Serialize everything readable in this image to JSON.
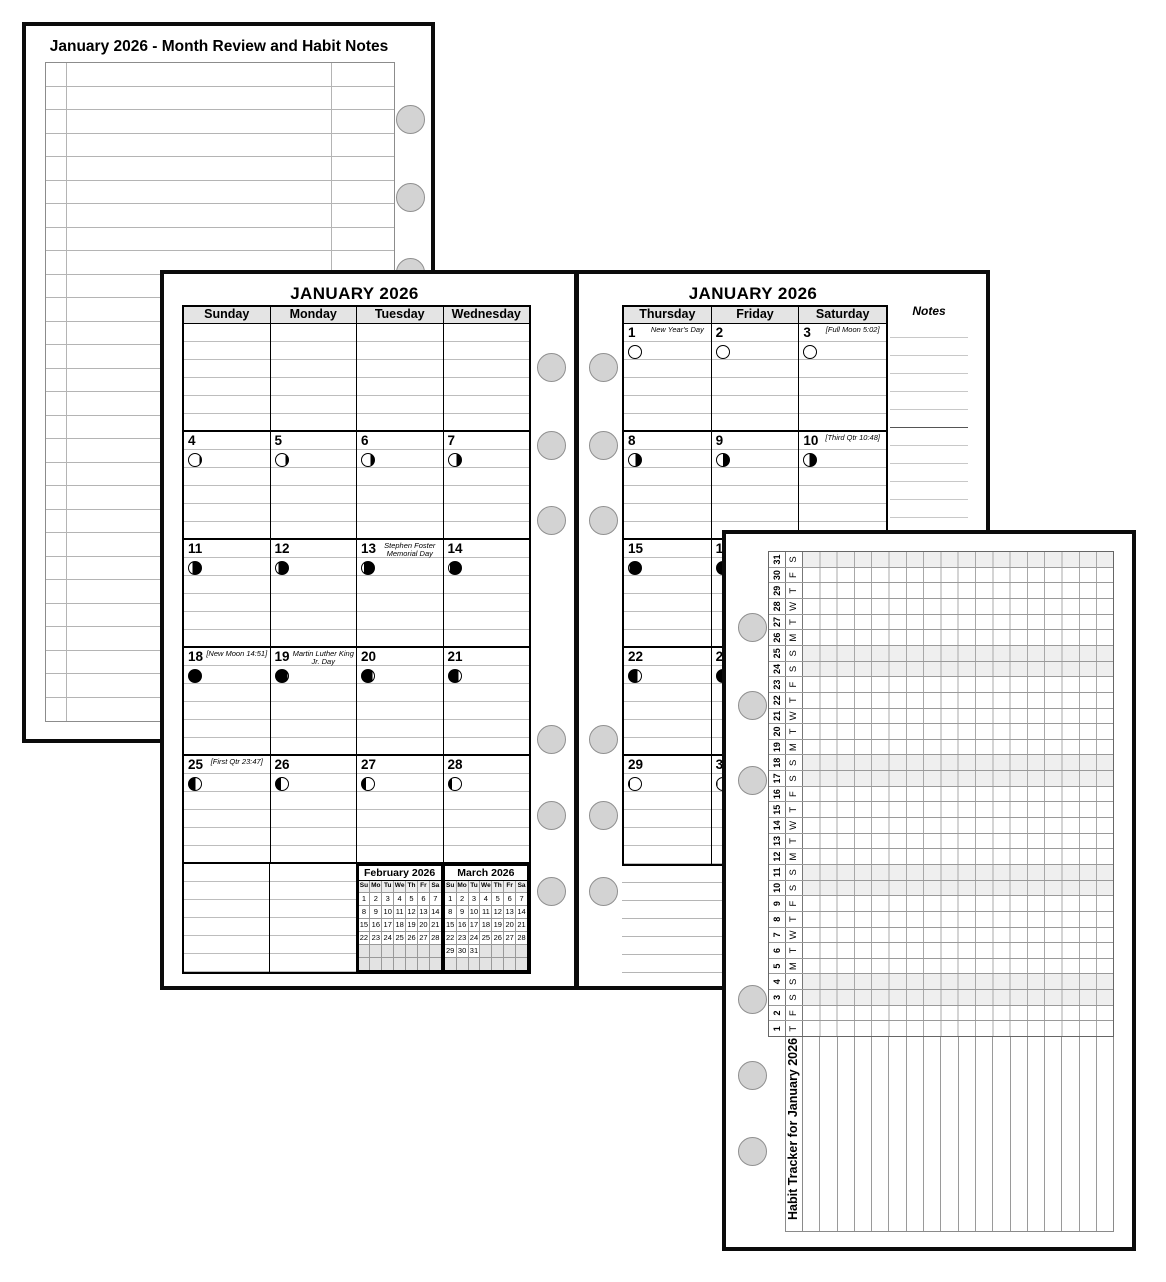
{
  "colors": {
    "page_border": "#0b0b0b",
    "header_bg": "#e4e4e4",
    "cell_rule_line": "#bdbdbd",
    "mini_empty_bg": "#e3e3e3",
    "weekend_shade": "#efefef",
    "hole_fill": "#d3d3d3",
    "hole_border": "#909090",
    "moon_dark": "#000000",
    "moon_light": "#ffffff"
  },
  "notes_page": {
    "title": "January 2026 - Month Review and Habit Notes",
    "row_count": 28
  },
  "left_calendar": {
    "title": "JANUARY 2026",
    "day_headers": [
      "Sunday",
      "Monday",
      "Tuesday",
      "Wednesday"
    ],
    "weeks": [
      [
        {},
        {},
        {},
        {}
      ],
      [
        {
          "date": "4",
          "moon": "A86"
        },
        {
          "date": "5",
          "moon": "A78"
        },
        {
          "date": "6",
          "moon": "A70"
        },
        {
          "date": "7",
          "moon": "A62"
        }
      ],
      [
        {
          "date": "11",
          "moon": "A30"
        },
        {
          "date": "12",
          "moon": "A22"
        },
        {
          "date": "13",
          "moon": "A16",
          "note": "Stephen Foster Memorial Day"
        },
        {
          "date": "14",
          "moon": "A10"
        }
      ],
      [
        {
          "date": "18",
          "moon": "B100",
          "note": "[New Moon 14:51]"
        },
        {
          "date": "19",
          "moon": "B96",
          "note": "Martin Luther King Jr. Day"
        },
        {
          "date": "20",
          "moon": "B88"
        },
        {
          "date": "21",
          "moon": "B80"
        }
      ],
      [
        {
          "date": "25",
          "moon": "B56",
          "note": "[First Qtr 23:47]"
        },
        {
          "date": "26",
          "moon": "B42"
        },
        {
          "date": "27",
          "moon": "B32"
        },
        {
          "date": "28",
          "moon": "B25"
        }
      ],
      [
        {},
        {}
      ]
    ],
    "mini_months": [
      {
        "title": "February 2026",
        "dow": [
          "Su",
          "Mo",
          "Tu",
          "We",
          "Th",
          "Fr",
          "Sa"
        ],
        "weeks": [
          [
            "1",
            "2",
            "3",
            "4",
            "5",
            "6",
            "7"
          ],
          [
            "8",
            "9",
            "10",
            "11",
            "12",
            "13",
            "14"
          ],
          [
            "15",
            "16",
            "17",
            "18",
            "19",
            "20",
            "21"
          ],
          [
            "22",
            "23",
            "24",
            "25",
            "26",
            "27",
            "28"
          ],
          [
            "",
            "",
            "",
            "",
            "",
            "",
            ""
          ],
          [
            "",
            "",
            "",
            "",
            "",
            "",
            ""
          ]
        ]
      },
      {
        "title": "March 2026",
        "dow": [
          "Su",
          "Mo",
          "Tu",
          "We",
          "Th",
          "Fr",
          "Sa"
        ],
        "weeks": [
          [
            "1",
            "2",
            "3",
            "4",
            "5",
            "6",
            "7"
          ],
          [
            "8",
            "9",
            "10",
            "11",
            "12",
            "13",
            "14"
          ],
          [
            "15",
            "16",
            "17",
            "18",
            "19",
            "20",
            "21"
          ],
          [
            "22",
            "23",
            "24",
            "25",
            "26",
            "27",
            "28"
          ],
          [
            "29",
            "30",
            "31",
            "",
            "",
            "",
            ""
          ],
          [
            "",
            "",
            "",
            "",
            "",
            "",
            ""
          ]
        ]
      }
    ]
  },
  "right_calendar": {
    "title": "JANUARY 2026",
    "day_headers": [
      "Thursday",
      "Friday",
      "Saturday"
    ],
    "notes_header": "Notes",
    "weeks": [
      [
        {
          "date": "1",
          "moon": "A100",
          "note": "New Year's Day"
        },
        {
          "date": "2",
          "moon": "A100"
        },
        {
          "date": "3",
          "moon": "A100",
          "note": "[Full Moon 5:02]"
        }
      ],
      [
        {
          "date": "8",
          "moon": "A55"
        },
        {
          "date": "9",
          "moon": "A50"
        },
        {
          "date": "10",
          "moon": "A44",
          "note": "[Third Qtr 10:48]"
        }
      ],
      [
        {
          "date": "15",
          "moon": "A6"
        },
        {
          "date": "16",
          "moon": "A0"
        },
        {
          "date": "17",
          "moon": "B100"
        }
      ],
      [
        {
          "date": "22",
          "moon": "B72"
        },
        {
          "date": "23",
          "moon": "B64"
        },
        {
          "date": "24",
          "moon": "B58"
        }
      ],
      [
        {
          "date": "29",
          "moon": "B10"
        },
        {
          "date": "30",
          "moon": "B4"
        },
        {
          "date": "31",
          "moon": "B0"
        }
      ]
    ]
  },
  "habit_tracker": {
    "title": "Habit Tracker for January 2026",
    "habit_rows": 18,
    "days": [
      {
        "n": "1",
        "d": "T"
      },
      {
        "n": "2",
        "d": "F"
      },
      {
        "n": "3",
        "d": "S"
      },
      {
        "n": "4",
        "d": "S"
      },
      {
        "n": "5",
        "d": "M"
      },
      {
        "n": "6",
        "d": "T"
      },
      {
        "n": "7",
        "d": "W"
      },
      {
        "n": "8",
        "d": "T"
      },
      {
        "n": "9",
        "d": "F"
      },
      {
        "n": "10",
        "d": "S"
      },
      {
        "n": "11",
        "d": "S"
      },
      {
        "n": "12",
        "d": "M"
      },
      {
        "n": "13",
        "d": "T"
      },
      {
        "n": "14",
        "d": "W"
      },
      {
        "n": "15",
        "d": "T"
      },
      {
        "n": "16",
        "d": "F"
      },
      {
        "n": "17",
        "d": "S"
      },
      {
        "n": "18",
        "d": "S"
      },
      {
        "n": "19",
        "d": "M"
      },
      {
        "n": "20",
        "d": "T"
      },
      {
        "n": "21",
        "d": "W"
      },
      {
        "n": "22",
        "d": "T"
      },
      {
        "n": "23",
        "d": "F"
      },
      {
        "n": "24",
        "d": "S"
      },
      {
        "n": "25",
        "d": "S"
      },
      {
        "n": "26",
        "d": "M"
      },
      {
        "n": "27",
        "d": "T"
      },
      {
        "n": "28",
        "d": "W"
      },
      {
        "n": "29",
        "d": "T"
      },
      {
        "n": "30",
        "d": "F"
      },
      {
        "n": "31",
        "d": "S"
      }
    ]
  }
}
